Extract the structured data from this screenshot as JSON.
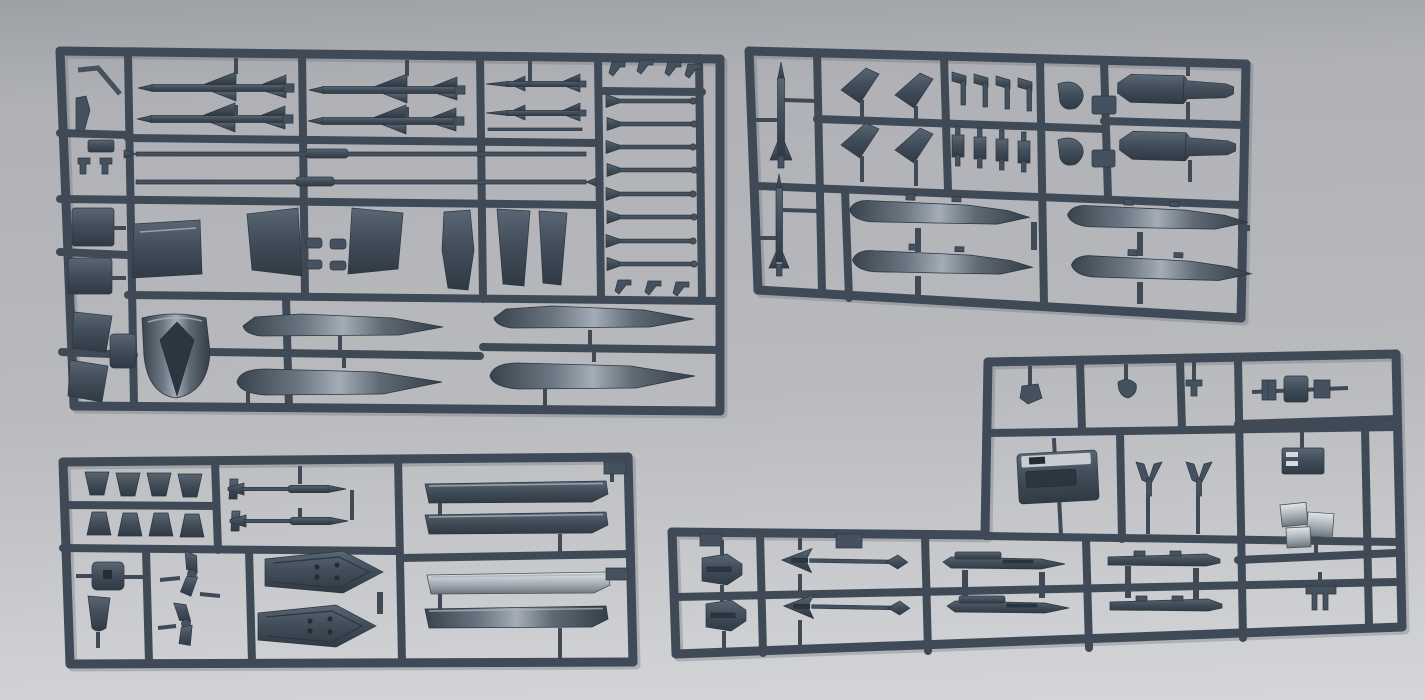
{
  "colors": {
    "bg-top": "#9da0a4",
    "bg-main": "#afb1b6",
    "bg-main2": "#b8babe",
    "bg-bottom": "#cdcfd3",
    "bg-lightest": "#d4d6da",
    "rail": "#3f4a56",
    "rail-hi": "#76818d",
    "part": "#46515f",
    "part-dark": "#2c3640",
    "part-mid": "#525e6b",
    "sheen-hi": "#aab3bc",
    "silver-hi": "#d6dadf",
    "pod-top": "#c9cdd3"
  },
  "scene": {
    "type": "photograph",
    "subject": "Four injection-molded plastic model kit sprues (runners) holding aircraft ordnance and accessory parts",
    "plastic_color_name": "dark blue-gray",
    "surface": "plain light gray tabletop, soft даylight, brighter toward bottom",
    "sprue_count": 4,
    "visible_text": "none legible (only tiny embossed part numbers on runners)"
  },
  "sprues": [
    {
      "id": "sprue-top-left",
      "position": "upper left, large rectangle approx (55,45)-(725,415), tilted slightly clockwise",
      "description": "Largest sprue with air-to-air missiles, long probes, launch-rail rods, wing fins, an intake scoop and drop-tank halves",
      "parts": [
        {
          "name": "sparrow-missile-half",
          "count": 4
        },
        {
          "name": "sidewinder-missile-half",
          "count": 2
        },
        {
          "name": "long-probe-rod",
          "count": 2
        },
        {
          "name": "flared-launch-rail-rod",
          "count": 8
        },
        {
          "name": "hook-clip",
          "count": 7
        },
        {
          "name": "access-panel-plate",
          "count": 1
        },
        {
          "name": "swept-wing-fin",
          "count": 2
        },
        {
          "name": "ramp-plate",
          "count": 2
        },
        {
          "name": "side-slab",
          "count": 1
        },
        {
          "name": "intake-scoop",
          "count": 1
        },
        {
          "name": "drop-tank-half",
          "count": 4
        },
        {
          "name": "bent-refueling-probe",
          "count": 1
        },
        {
          "name": "small-block",
          "count": 2
        },
        {
          "name": "blade-fin",
          "count": 2
        },
        {
          "name": "clamp-piece",
          "count": 2
        }
      ]
    },
    {
      "id": "sprue-top-right",
      "position": "upper right, approx (745,48)-(1250,320), tilted clockwise about 2 degrees",
      "description": "Sprue with two slender missile bodies, arrowhead fins, small finlets, two bombs and four drop-tank halves",
      "parts": [
        {
          "name": "slender-missile-body",
          "count": 2
        },
        {
          "name": "arrowhead-fin",
          "count": 4
        },
        {
          "name": "flag-finlet",
          "count": 4
        },
        {
          "name": "bone-finlet",
          "count": 4
        },
        {
          "name": "curved-fairing",
          "count": 2
        },
        {
          "name": "pylon-block",
          "count": 2
        },
        {
          "name": "bomb-body",
          "count": 2
        },
        {
          "name": "drop-tank-half",
          "count": 4
        }
      ]
    },
    {
      "id": "sprue-bottom-left",
      "position": "lower left, approx (62,455)-(635,665)",
      "description": "Sprue with eight trapezoid fins, two finned rockets, four launcher rails (one with bright silver reflection), hub block, tail blade, two fin pairs and two arrow-shaped rail shoes",
      "parts": [
        {
          "name": "trapezoid-fin",
          "count": 8
        },
        {
          "name": "finned-rocket",
          "count": 2
        },
        {
          "name": "launcher-rail",
          "count": 4
        },
        {
          "name": "hub-block",
          "count": 1
        },
        {
          "name": "tail-blade",
          "count": 1
        },
        {
          "name": "joined-fin-pair",
          "count": 2
        },
        {
          "name": "arrow-rail-shoe",
          "count": 2
        }
      ]
    },
    {
      "id": "sprue-bottom-right",
      "position": "right, L-shaped, approx (670,355)-(1405,660)",
      "description": "L-shaped sprue with an equipment pod, small brackets and links, bright metal-sheen clips, two fin caps, two dart missiles, two winged missile bodies and two pylon planks",
      "parts": [
        {
          "name": "small-detail-part",
          "count": 3
        },
        {
          "name": "linkage-assembly",
          "count": 1
        },
        {
          "name": "equipment-pod",
          "count": 1
        },
        {
          "name": "y-bracket",
          "count": 2
        },
        {
          "name": "slotted-bracket",
          "count": 1
        },
        {
          "name": "bright-clip-cluster",
          "count": 1
        },
        {
          "name": "small-leg-bracket",
          "count": 1
        },
        {
          "name": "fin-cap",
          "count": 2
        },
        {
          "name": "dart-missile",
          "count": 2
        },
        {
          "name": "winged-missile-body",
          "count": 2
        },
        {
          "name": "pylon-plank",
          "count": 2
        }
      ]
    }
  ]
}
